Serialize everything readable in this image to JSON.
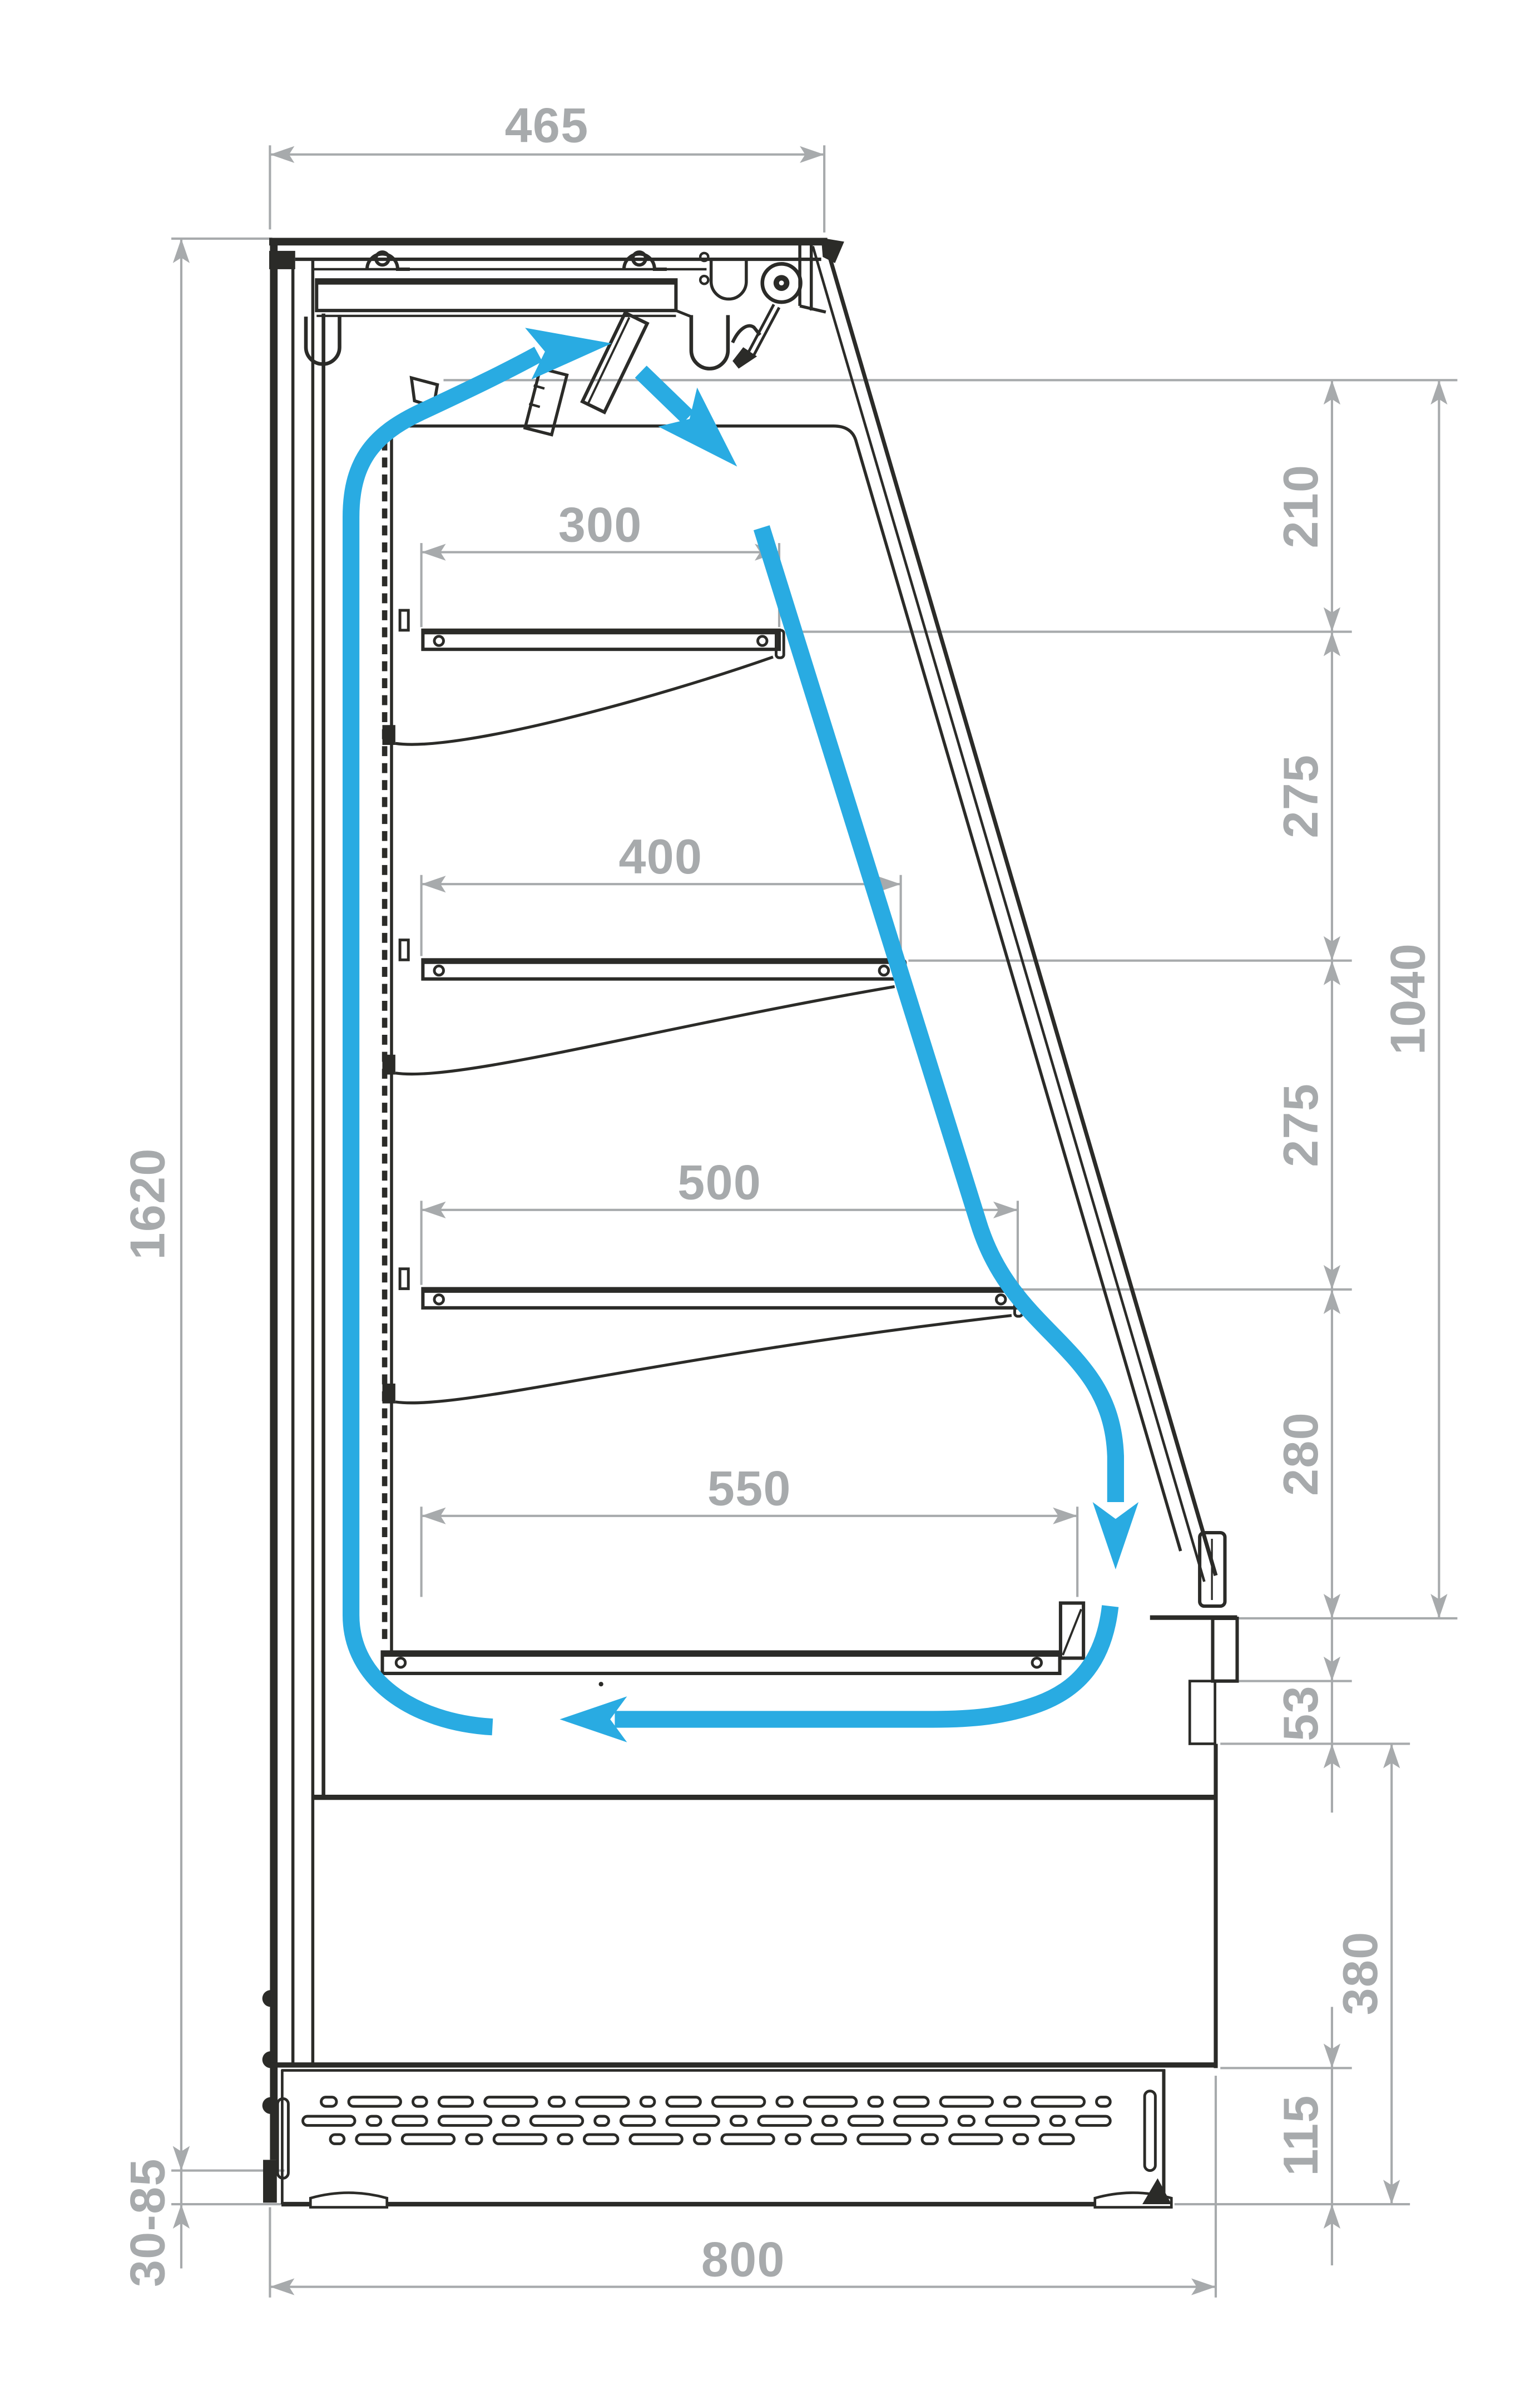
{
  "drawing": {
    "type": "technical-section-diagram",
    "subject": "open-front refrigerated display case side section with recirculating airflow",
    "units": "mm",
    "colors": {
      "outline": "#2b2b28",
      "dimension": "#a7aaac",
      "airflow": "#29abe2",
      "background": "#ffffff"
    },
    "dimensions": {
      "top_depth": "465",
      "air_outlet_to_shelf1": "210",
      "shelf1_to_shelf2": "275",
      "shelf2_to_shelf3": "275",
      "shelf3_to_base_shelf": "280",
      "display_opening_height": "1040",
      "overall_height": "1620",
      "shelf1_depth": "300",
      "shelf2_depth": "400",
      "shelf3_depth": "500",
      "base_shelf_depth": "550",
      "front_air_gap": "53",
      "base_section_height": "380",
      "vent_grille_height": "115",
      "foot_height_range": "30-85",
      "overall_depth": "800"
    },
    "airflow_arrows": [
      {
        "name": "top-discharge-arrow",
        "direction": "right"
      },
      {
        "name": "glass-downflow-arrow",
        "direction": "down-right"
      },
      {
        "name": "front-return-arrow",
        "direction": "down"
      },
      {
        "name": "base-return-arrow",
        "direction": "left"
      }
    ]
  }
}
